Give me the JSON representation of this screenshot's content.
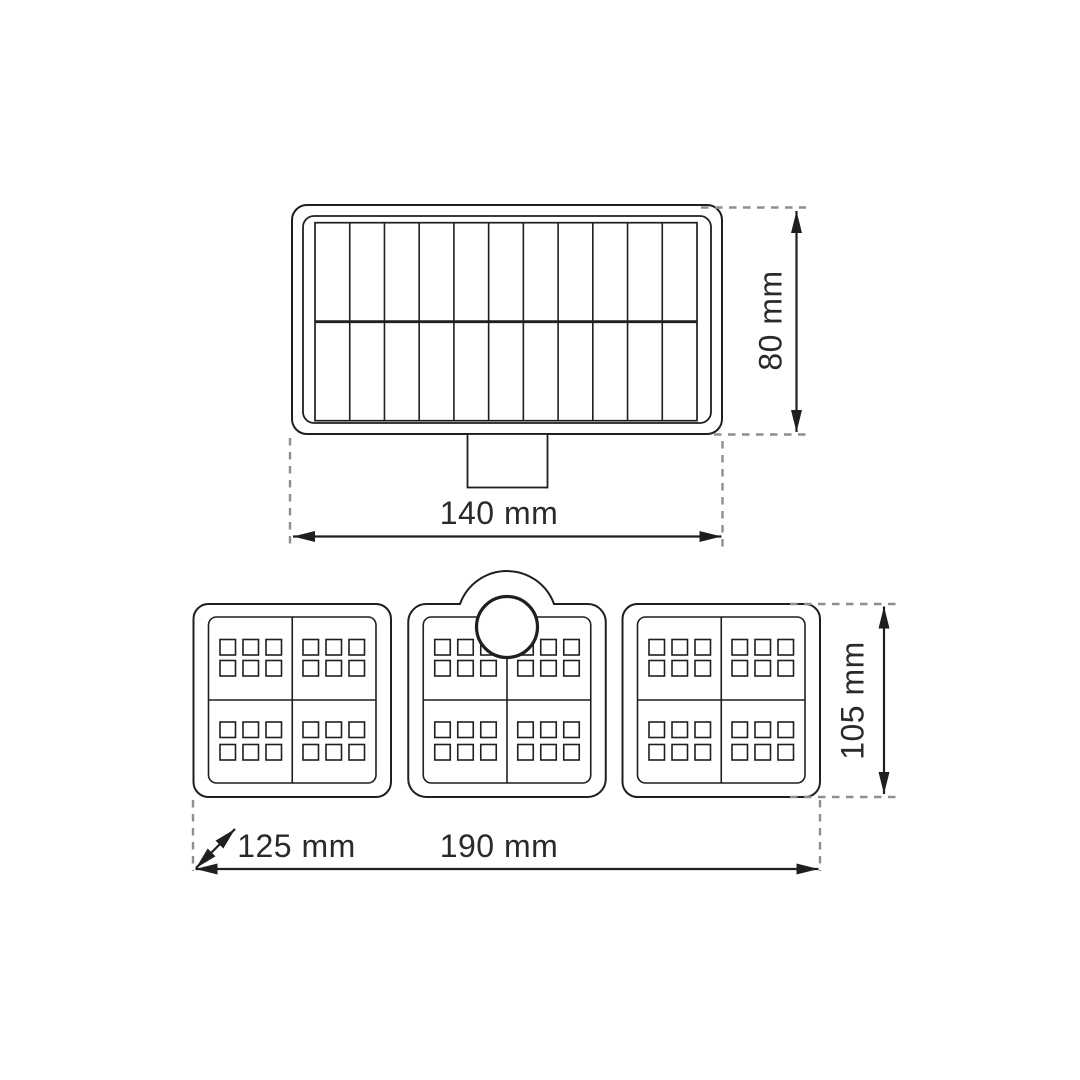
{
  "diagram": {
    "type": "technical-dimension-drawing",
    "product": "solar sensor wall light",
    "views": {
      "solar_panel_top_view": {
        "solar_cell_columns": 11,
        "solar_cell_rows": 2,
        "has_mounting_bracket": true,
        "width_label": "140 mm",
        "height_label": "80 mm"
      },
      "led_head_front_view": {
        "panel_count": 3,
        "quadrants_per_panel": 4,
        "led_squares_per_quadrant": 6,
        "has_motion_sensor": true,
        "width_label": "190 mm",
        "height_label": "105 mm",
        "depth_label": "125 mm"
      }
    },
    "colors": {
      "line": "#1f1f1f",
      "dash": "#8e8e8e",
      "text": "#2a2a2a",
      "background": "#ffffff"
    }
  }
}
